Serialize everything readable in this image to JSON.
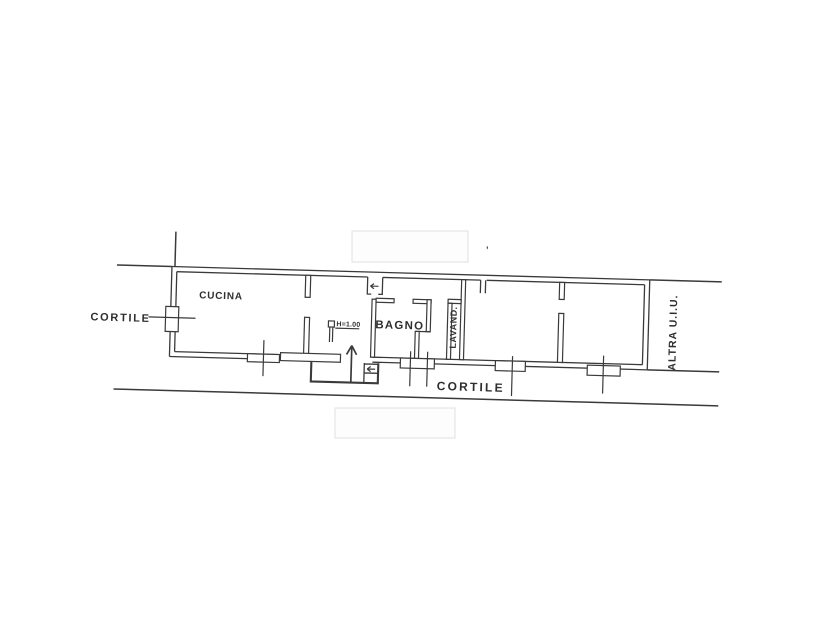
{
  "plan": {
    "rooms": {
      "cucina": "CUCINA",
      "bagno": "BAGNO",
      "lavanderia": "LAVAND."
    },
    "annotations": {
      "cortile_left": "CORTILE",
      "cortile_bottom": "CORTILE",
      "altra_uiu": "ALTRA U.I.U.",
      "height_note": "H=1.00",
      "stray_mark": "’"
    },
    "colors": {
      "ink": "#3a3a3a",
      "paper": "#ffffff",
      "redaction_edge": "#e0e0e0"
    }
  }
}
